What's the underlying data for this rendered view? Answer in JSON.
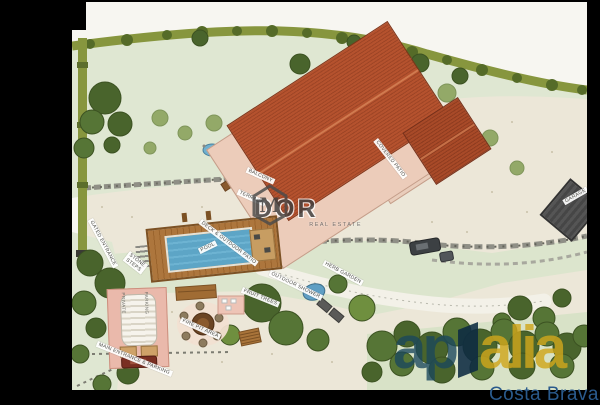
{
  "plan": {
    "labels": {
      "gated_entrance": "GATED ENTRANCE",
      "balcony": "BALCONY",
      "terrace": "TERRACE",
      "covered_patio": "COVERED PATIO",
      "deck": "DECK & OUTDOOR PATIO",
      "pool": "POOL",
      "stone_steps_1": "STONE",
      "stone_steps_2": "STEPS",
      "outdoor_shower": "OUTDOOR SHOWER",
      "herb_garden": "HERB GARDEN",
      "fruit_trees": "FRUIT TREES",
      "fire_pit": "FIRE PIT AREA",
      "parking_1": "PRIVATE",
      "parking_2": "PARKING",
      "main_entrance": "MAIN ENTRANCE & PARKING",
      "garage": "GARAGE"
    },
    "watermark": {
      "initial": "M",
      "name": "DOR",
      "tagline": "REAL ESTATE"
    },
    "logo": {
      "prefix": "ap",
      "suffix": "alia",
      "subtitle": "Costa Brava"
    },
    "colors": {
      "roof": "#b5522e",
      "roof_dark": "#8f3c20",
      "pool_water": "#5da5c6",
      "deck_wood": "#ad763d",
      "hedge": "#87963e",
      "tree_dark": "#49642c",
      "lawn": "#dfe7d2",
      "gravel": "#ece7d8",
      "stone_wall": "#8f8f86",
      "flowers": "#e08cb4",
      "logo_blue": "#1a465c",
      "logo_gold": "#d0a61c",
      "frame": "#000000"
    }
  }
}
